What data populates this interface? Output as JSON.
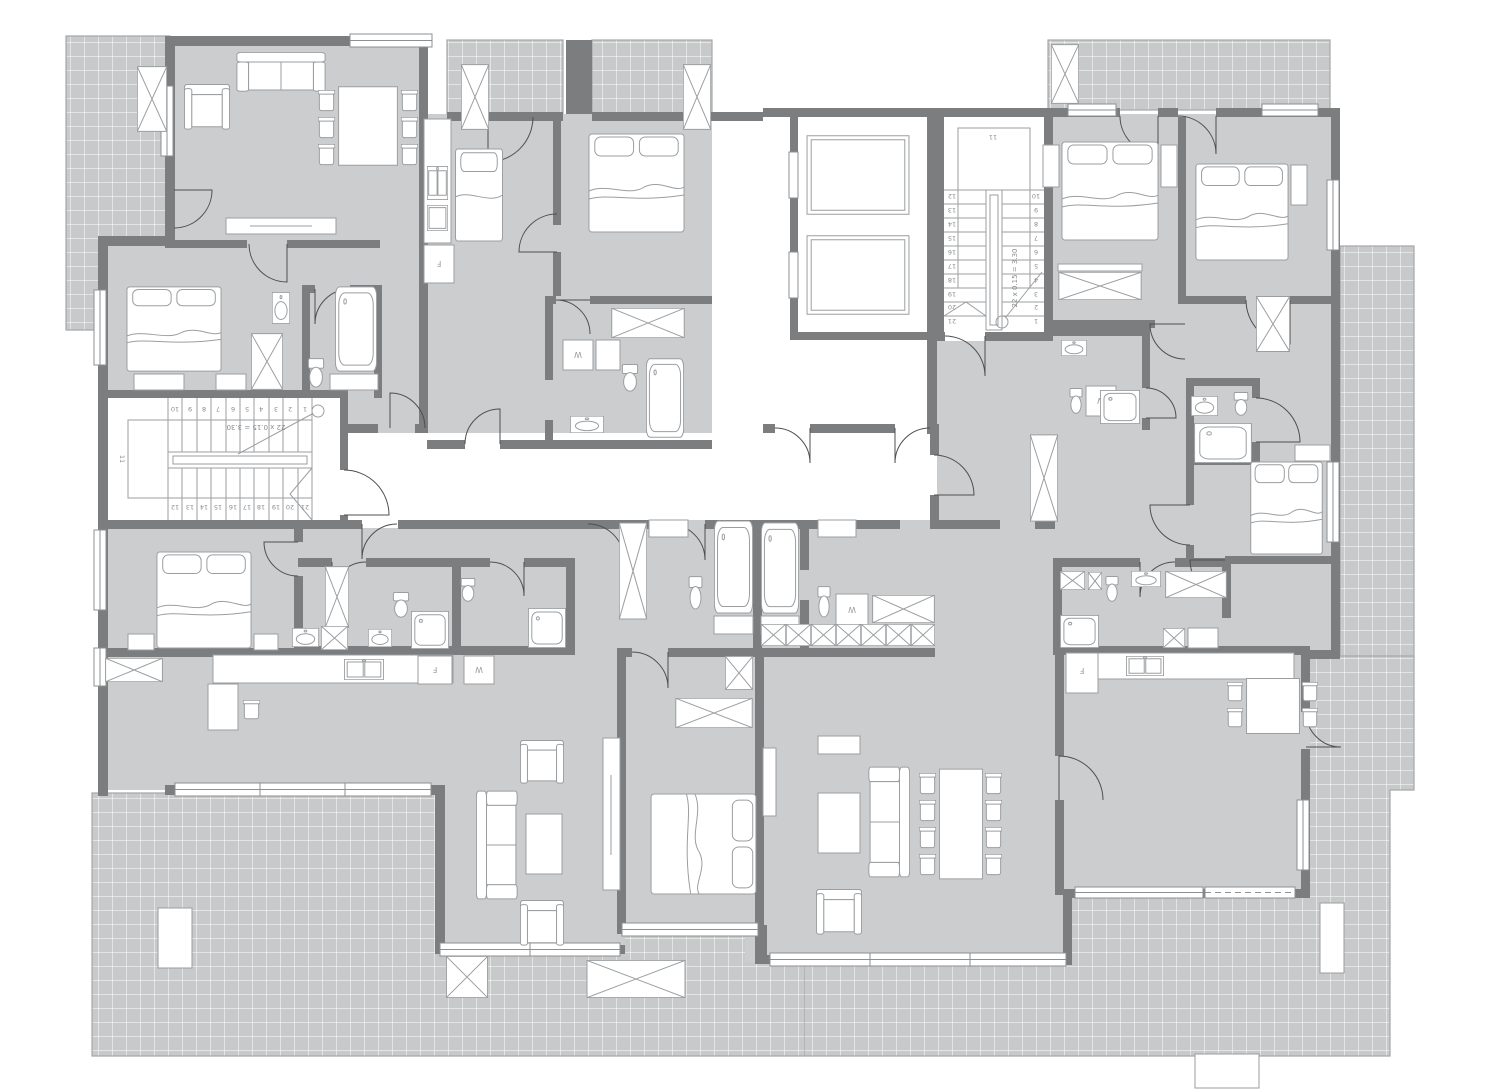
{
  "drawing": {
    "kind": "residential-apartment-floor-plan",
    "stair_left": {
      "annotation": "22 x 0.15 = 3.30",
      "landing_label": "11",
      "top_row": [
        "10",
        "9",
        "8",
        "7",
        "6",
        "5",
        "4",
        "3",
        "2",
        "1"
      ],
      "bottom_row": [
        "12",
        "13",
        "14",
        "15",
        "16",
        "17",
        "18",
        "19",
        "20",
        "21"
      ]
    },
    "stair_right": {
      "annotation": "22 x 0.15 = 3.30",
      "landing_label": "11",
      "right_col": [
        "10",
        "9",
        "8",
        "7",
        "6",
        "5",
        "4",
        "3",
        "2",
        "1"
      ],
      "left_col": [
        "12",
        "13",
        "14",
        "15",
        "16",
        "17",
        "18",
        "19",
        "20",
        "21"
      ]
    },
    "appliance_labels": {
      "washer": "W",
      "fridge": "F"
    },
    "colors": {
      "wall": "#7b7d7f",
      "apartment_floor": "#cccdcf",
      "terrace_tile": "#c7c9ca",
      "tile_grid": "#ffffff",
      "fixture_outline": "#9b9ea0",
      "door_arc": "#4f4f4f",
      "background": "#ffffff"
    }
  }
}
